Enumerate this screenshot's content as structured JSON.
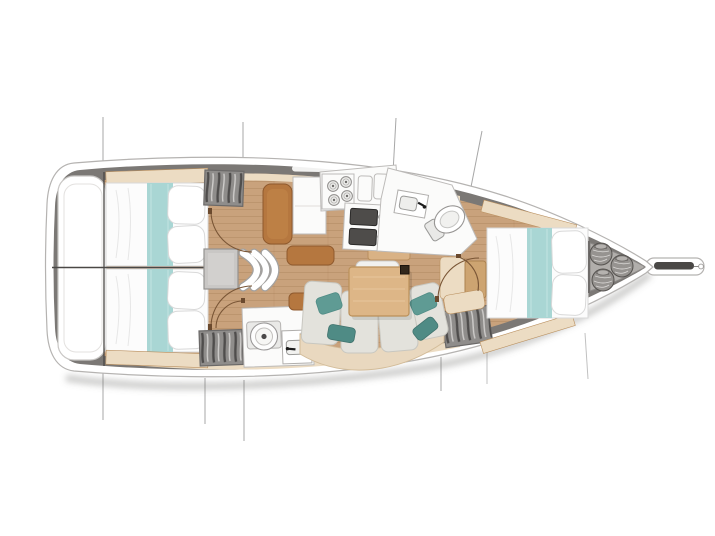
{
  "canvas": {
    "width": 715,
    "height": 536,
    "background": "#ffffff"
  },
  "diagram": {
    "type": "yacht-interior-floor-plan",
    "orientation": "bow-right",
    "visible_text": "none"
  },
  "inventory": {
    "double_berths": 3,
    "aft_cabins": 2,
    "forward_cabins": 1,
    "heads": 2,
    "toilets": 2,
    "bathroom_sinks": 2,
    "galley_burners": 4,
    "galley_sinks": 2,
    "companionway_steps": 3,
    "hanging_lockers": 3,
    "anchor_rope_coils": 3,
    "salon_seat_cushions": 4,
    "salon_teal_pillows": 4,
    "rigging_lines_above": 4,
    "rigging_lines_below": 6
  },
  "colors": {
    "bg": "#ffffff",
    "hull_white": "#ffffff",
    "hull_outline": "#b5b3b1",
    "deck_band": "#7b7875",
    "floor_wood": "#c9a27c",
    "wood_trim": "#d9b285",
    "wood_dark": "#b98f5e",
    "panel_cream": "#ecdcc3",
    "furniture_white": "#fbfbfa",
    "furniture_stroke": "#bdbbb9",
    "bed_white": "#fcfcfc",
    "cushion_gray": "#e3e2dc",
    "cushion_stroke": "#c8c7c0",
    "teal_light": "#a9d6d4",
    "teal_dark": "#5f9b94",
    "teal_deeper": "#4f8b85",
    "seat_brown": "#b5773f",
    "seat_brown_dark": "#8f5a2e",
    "locker_gray": "#8f8d8b",
    "anchor_gray": "#b1aeab",
    "steel_dark": "#4a4846",
    "line_gray": "#a7a7a7",
    "door_arc": "#7a5636",
    "divider": "#4a4846"
  }
}
